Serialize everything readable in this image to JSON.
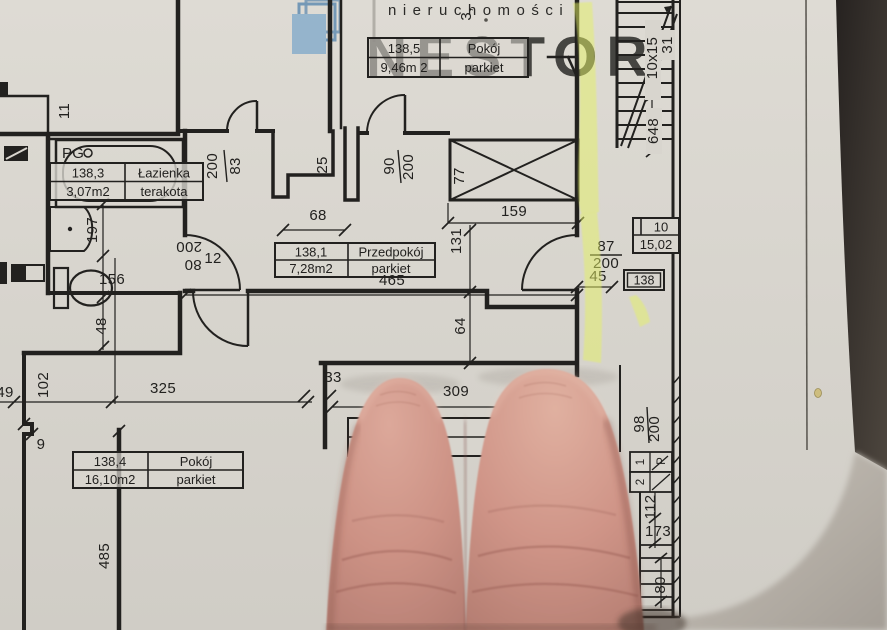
{
  "brand": {
    "name": "NESTOR",
    "tagline": "nieruchomości"
  },
  "tables": {
    "room5": {
      "no": "138,5",
      "name": "Pokój",
      "area": "9,46m 2",
      "floor": "parkiet"
    },
    "bath": {
      "no": "138,3",
      "name": "Łazienka",
      "area": "3,07m2",
      "floor": "terakota"
    },
    "hall": {
      "no": "138,1",
      "name": "Przedpokój",
      "area": "7,28m2",
      "floor": "parkiet"
    },
    "room4": {
      "no": "138,4",
      "name": "Pokój",
      "area": "16,10m2",
      "floor": "parkiet"
    },
    "corridor": {
      "no": "10",
      "area": "15,02"
    }
  },
  "labels": {
    "unit": "138",
    "pg": "PG",
    "flight1": "1",
    "flightP": "P",
    "flight2": "2"
  },
  "stairs": {
    "steps": "10x15",
    "tread": "31",
    "run": "648"
  },
  "dims": {
    "n11": "11",
    "n197": "197",
    "n156": "156",
    "n48": "48",
    "n49": "49",
    "n102": "102",
    "n325": "325",
    "n9": "9",
    "n485": "485",
    "n68": "68",
    "n465": "465",
    "n131": "131",
    "n64": "64",
    "n33": "33",
    "n309": "309",
    "n12": "12",
    "n25": "25",
    "n159": "159",
    "n77": "77",
    "n45": "45",
    "n87": "87",
    "n87h": "200",
    "d83h": "200",
    "d83w": "83",
    "d90w": "90",
    "d90h": "200",
    "d80h": "200",
    "d80w": "80",
    "d98w": "98",
    "d98h": "200",
    "n112": "112",
    "n173": "173",
    "n80": "80",
    "top3": "3,"
  },
  "colors": {
    "ink": "#22211f",
    "paper": "#d8d5ce",
    "highlight": "#e6f263",
    "logoBlue": "#92b3cc"
  }
}
